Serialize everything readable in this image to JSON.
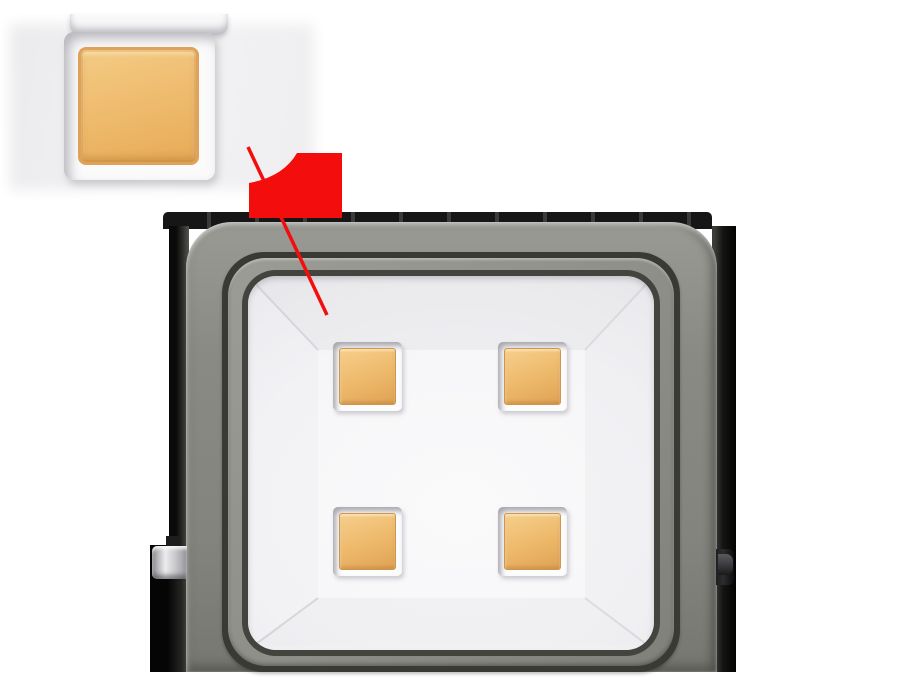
{
  "image": {
    "type": "product-render",
    "subject": "LED floodlight front view, 4-chip COB array, with magnified close-up inset of one LED chip and red callout pointer",
    "background": "#ffffff",
    "width": 900,
    "height": 695
  },
  "colors": {
    "body_gray": "#8a8a84",
    "body_gray_light": "#9a9a94",
    "body_gray_dark": "#777771",
    "groove_dark": "#3a3a34",
    "groove_dark_2": "#44443e",
    "ridge_gray": "#92928d",
    "reflector_white": "#fafafb",
    "reflector_edge": "#e3e3e6",
    "led_amber": "#eeba6c",
    "led_amber_light": "#f6cf8d",
    "led_amber_dark": "#e0a254",
    "led_amber_border": "#d1954a",
    "callout_red": "#f40d0d",
    "fin_dark": "#161616",
    "bracket_dark": "#2c2c2e",
    "bracket_metal_light": "#ececee",
    "bracket_metal_dark": "#97979b",
    "inset_bg": "#ebebed"
  },
  "floodlight": {
    "name": "led-floodlight",
    "led_count": 4,
    "led_grid": {
      "rows": 2,
      "cols": 2
    },
    "led_size": 55,
    "led_frame_size": 69,
    "leds": [
      {
        "id": "led-top-left",
        "x": 340,
        "y": 349
      },
      {
        "id": "led-top-right",
        "x": 505,
        "y": 349
      },
      {
        "id": "led-bottom-left",
        "x": 340,
        "y": 514
      },
      {
        "id": "led-bottom-right",
        "x": 505,
        "y": 514
      }
    ]
  },
  "inset": {
    "name": "magnified-led-inset",
    "shows": "close-up of a single amber LED chip in its white recessed frame"
  },
  "callout": {
    "name": "red-callout",
    "line_from": {
      "x": 248,
      "y": 147
    },
    "line_to": {
      "x": 327,
      "y": 315
    },
    "flag": {
      "x": 249,
      "y": 152,
      "width": 93,
      "height": 66
    },
    "line_width": 3.5
  }
}
